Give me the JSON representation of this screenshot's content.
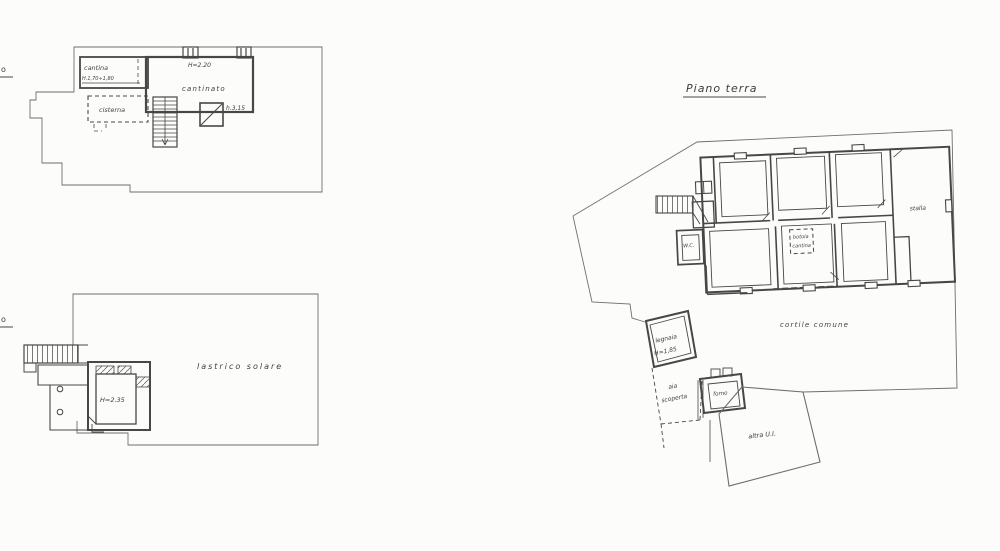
{
  "canvas": {
    "background": "#fcfcfa",
    "ink": "#474747"
  },
  "basement_plan": {
    "clipped_title_fragment": "o",
    "cantina_label": "cantina",
    "cantina_height": "H.1,70÷1,80",
    "cisterna_label": "cisterna",
    "cantinato_label": "cantinato",
    "cantinato_height": "H=2.20",
    "lightwell_height": "h.3,15"
  },
  "terrace_plan": {
    "clipped_title_fragment": "o",
    "lastrico_label": "lastrico solare",
    "room_height": "H=2.35"
  },
  "ground_plan": {
    "title": "Piano terra",
    "wc_label": "W.C.",
    "botola_line1": "botola",
    "botola_line2": "cantina",
    "stalla_label": "stalla",
    "cortile_label": "cortile comune",
    "legnaia_label": "legnaia",
    "legnaia_height": "H=1,85",
    "aia_line1": "aia",
    "aia_line2": "scoperta",
    "forno_label": "forno",
    "altra_ui_label": "altra U.I."
  }
}
